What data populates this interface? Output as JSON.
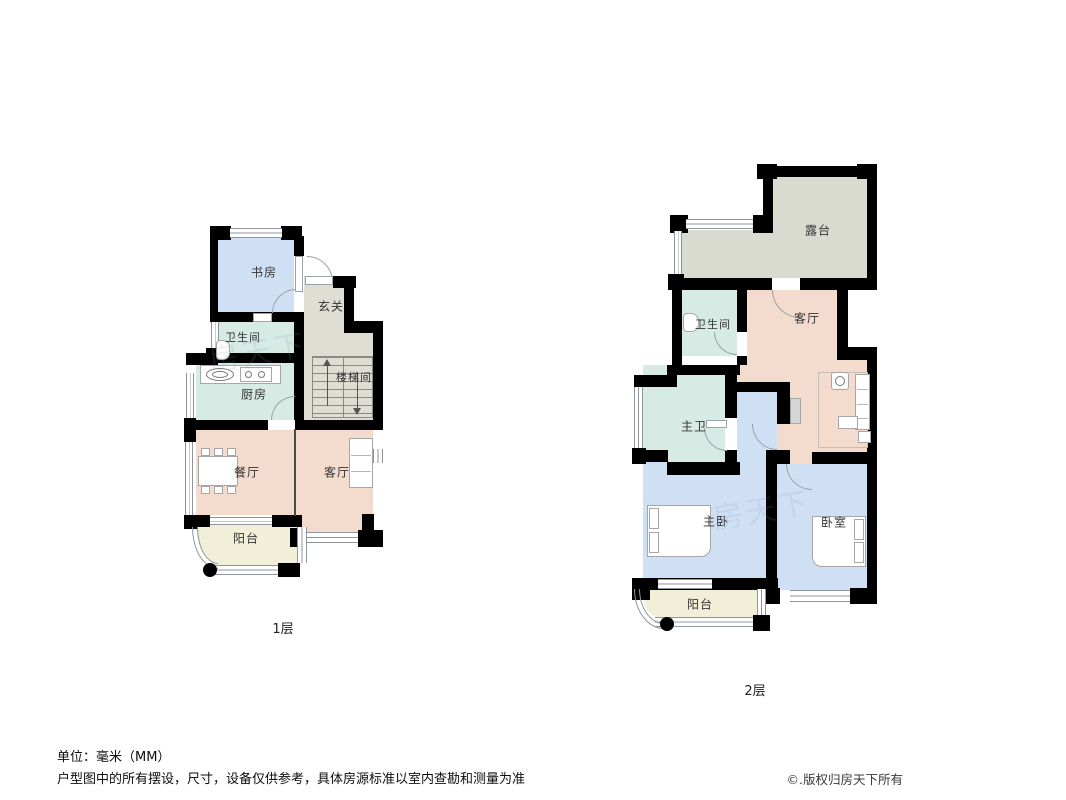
{
  "floors": [
    {
      "caption": "1层",
      "rooms": [
        {
          "id": "study",
          "label": "书房"
        },
        {
          "id": "foyer",
          "label": "玄关"
        },
        {
          "id": "bathroom",
          "label": "卫生间"
        },
        {
          "id": "kitchen",
          "label": "厨房"
        },
        {
          "id": "stairwell",
          "label": "楼梯间"
        },
        {
          "id": "dining-room",
          "label": "餐厅"
        },
        {
          "id": "living-room",
          "label": "客厅"
        },
        {
          "id": "balcony",
          "label": "阳台"
        }
      ]
    },
    {
      "caption": "2层",
      "rooms": [
        {
          "id": "terrace",
          "label": "露台"
        },
        {
          "id": "bathroom",
          "label": "卫生间"
        },
        {
          "id": "living-room",
          "label": "客厅"
        },
        {
          "id": "master-bathroom",
          "label": "主卫"
        },
        {
          "id": "master-bedroom",
          "label": "主卧"
        },
        {
          "id": "bedroom",
          "label": "卧室"
        },
        {
          "id": "balcony",
          "label": "阳台"
        }
      ]
    }
  ],
  "footer": {
    "unit": "单位：毫米（MM）",
    "disclaimer": "户型图中的所有摆设，尺寸，设备仅供参考，具体房源标准以室内查勘和测量为准",
    "copyright": "©.版权归房天下所有"
  },
  "watermark": "房天下",
  "colors": {
    "wall": "#000000",
    "room_blue": "#cfe0f5",
    "room_teal": "#d5ebe3",
    "room_gray": "#e0ded4",
    "room_terrace": "#d9dbd0",
    "room_pink": "#f3dccd",
    "room_cream": "#f1efd8",
    "window_line": "#8f959e",
    "furniture_border": "#a6a6a6",
    "label_text": "#333333"
  }
}
